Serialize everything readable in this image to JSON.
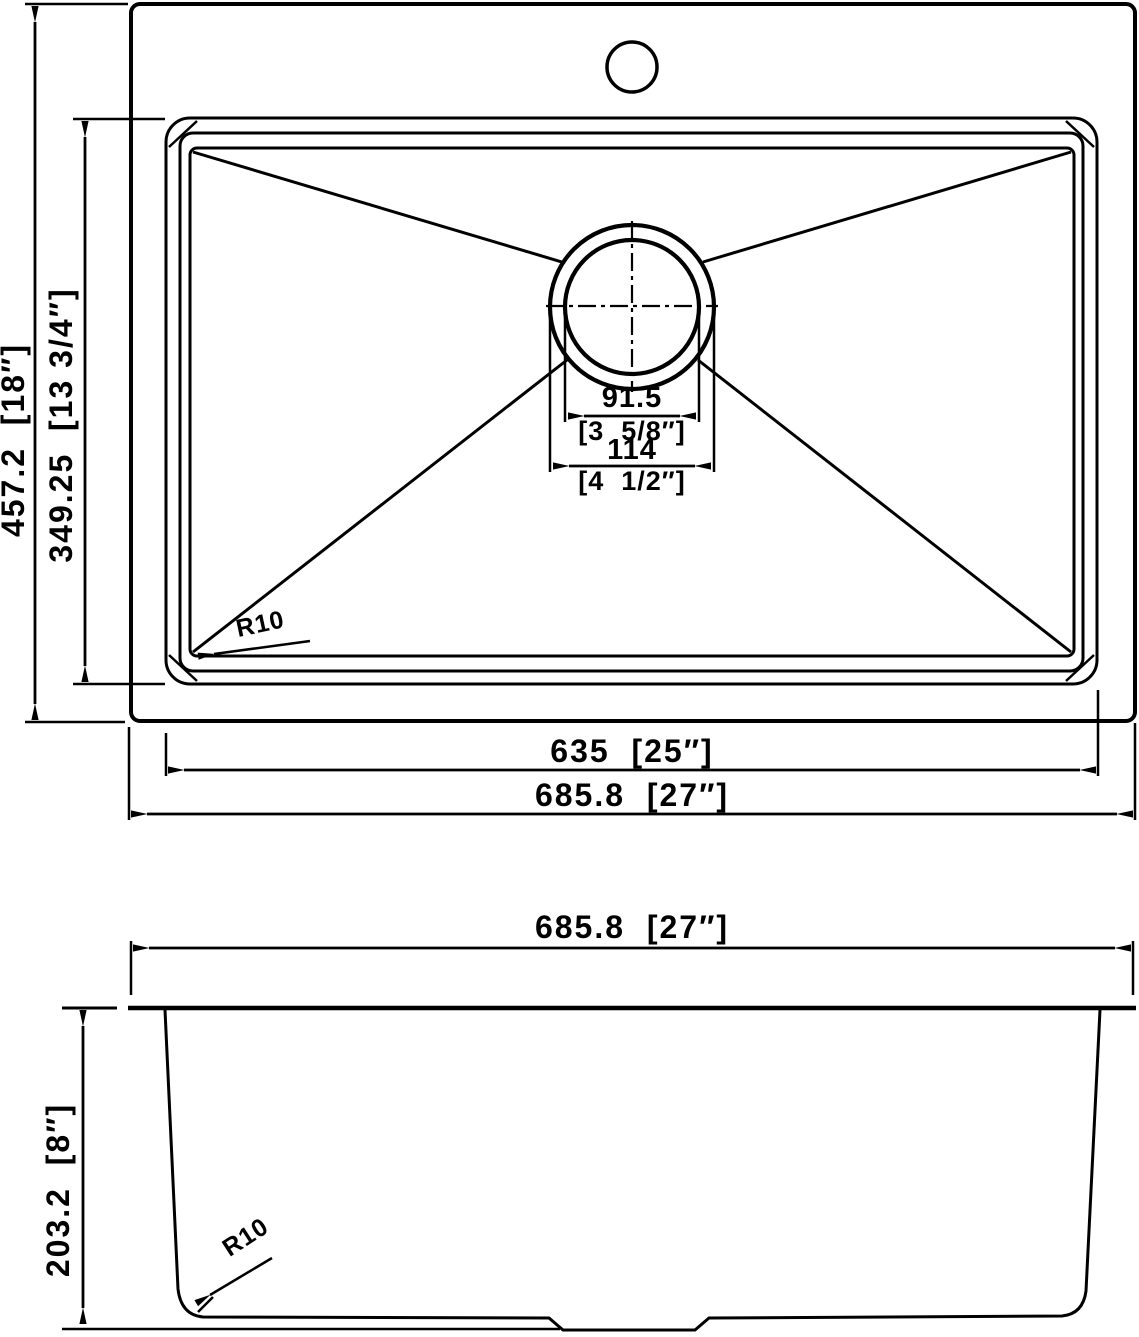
{
  "drawing": {
    "title": "kitchen sink dimension drawing",
    "colors": {
      "ink": "#000000",
      "paper": "#ffffff"
    },
    "top_view": {
      "labels": {
        "overall_height": "457.2  [18″]",
        "bowl_height": "349.25  [13 3/4″]",
        "drain_strainer_mm": "91.5",
        "drain_strainer_in": "[3  5/8″]",
        "drain_opening_mm": "114",
        "drain_opening_in": "[4  1/2″]",
        "bowl_width": "635  [25″]",
        "overall_width": "685.8  [27″]",
        "corner_radius": "R10"
      }
    },
    "side_view": {
      "labels": {
        "overall_width": "685.8  [27″]",
        "depth": "203.2  [8″]",
        "corner_radius": "R10"
      }
    }
  }
}
